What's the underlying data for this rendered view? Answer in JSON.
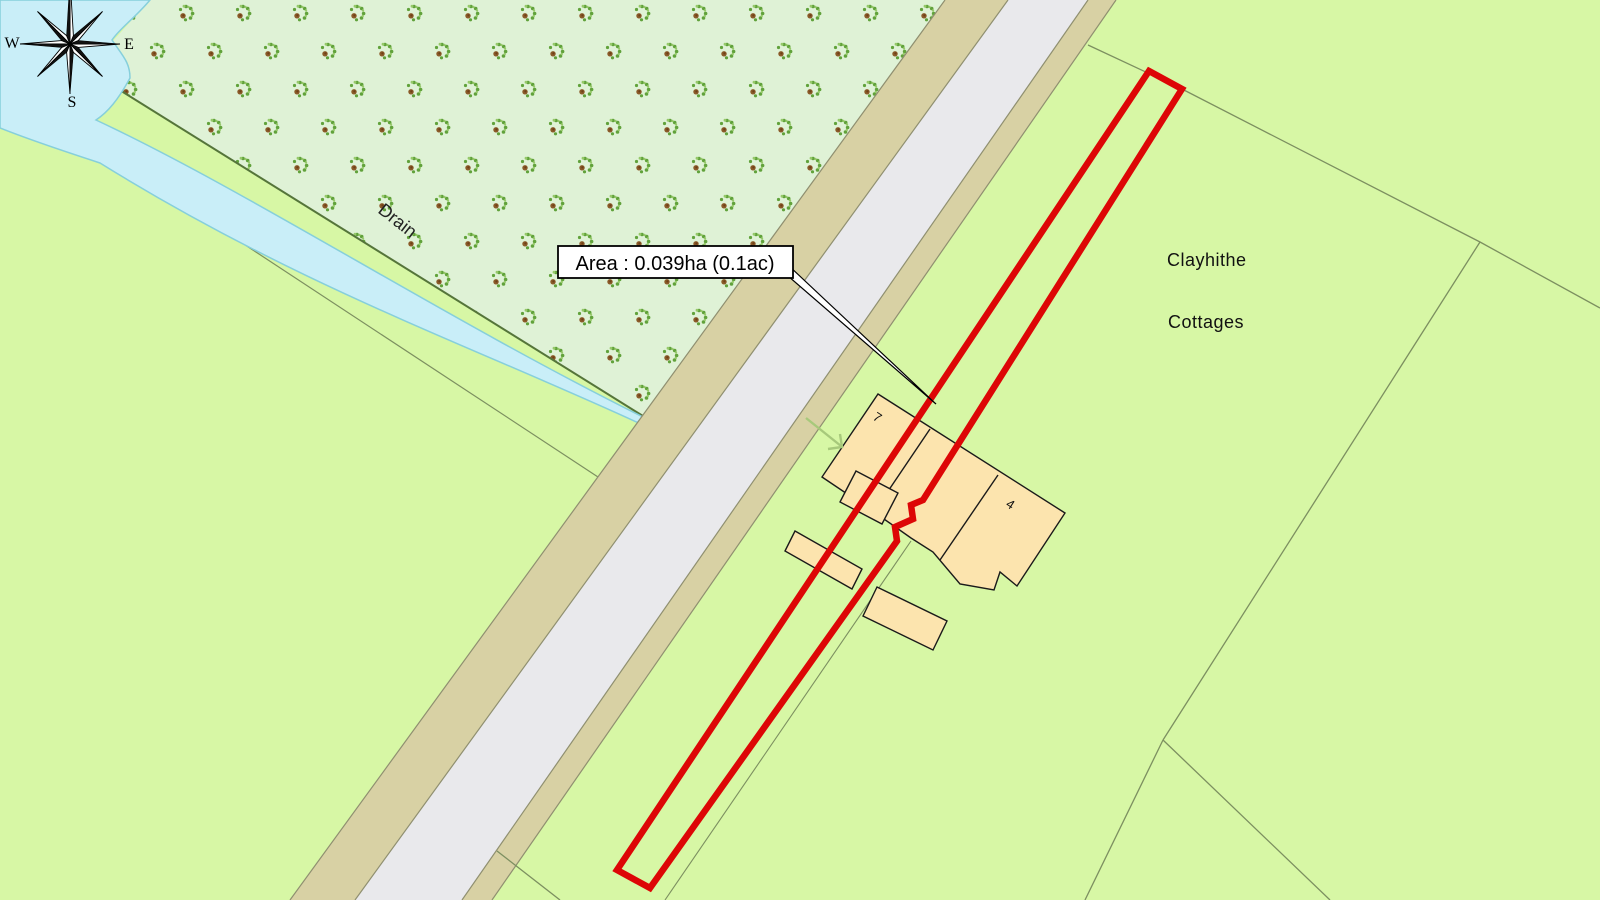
{
  "map": {
    "annotation": {
      "area_label": "Area : 0.039ha (0.1ac)"
    },
    "labels": {
      "place_line1": "Clayhithe",
      "place_line2": "Cottages",
      "drain": "Drain",
      "building_7": "7",
      "building_4": "4"
    },
    "compass": {
      "west": "W",
      "east": "E",
      "south": "S"
    },
    "colors": {
      "field_green": "#d7f7a5",
      "orchard_green": "#dff2d6",
      "water_blue": "#c9eef8",
      "water_edge": "#86cfdb",
      "road_surface_gray": "#e9e9ec",
      "verge_tan": "#d8d1a4",
      "road_edge": "#8f8f70",
      "field_boundary": "#7c8f60",
      "orchard_boundary": "#55753a",
      "building_fill": "#fce4ae",
      "building_outline": "#1a1a1a",
      "plot_red": "#dd0606",
      "arrow_green": "#a7c97b"
    }
  }
}
